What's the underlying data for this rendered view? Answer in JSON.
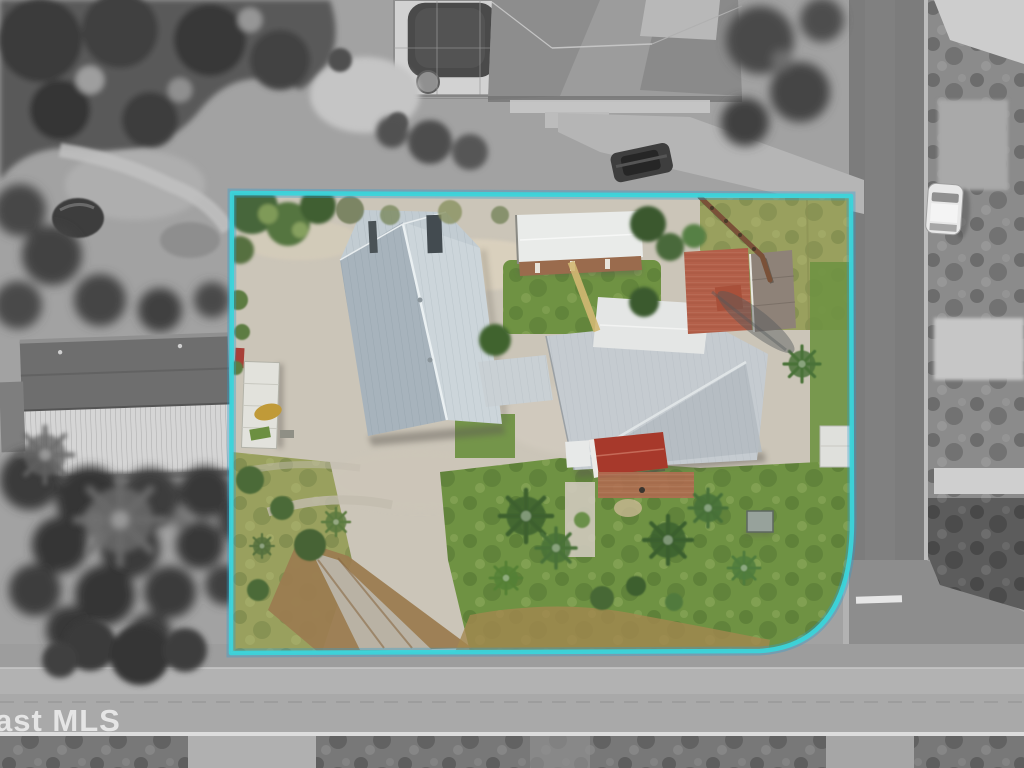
{
  "image": {
    "kind": "aerial-drone-photo",
    "width": 1024,
    "height": 768,
    "description": "Top-down aerial photo of a residential lot outlined in cyan; everything outside the outline is desaturated to grayscale"
  },
  "watermark": {
    "text": "ast MLS",
    "color": "rgba(255,255,255,0.82)"
  },
  "lot_outline": {
    "stroke_width": 4.5,
    "rounded_corner": "bottom-right",
    "corners": {
      "top_left": [
        232,
        193
      ],
      "top_right": [
        851,
        196
      ],
      "curve_start_right": [
        852,
        518
      ],
      "curve_end_bottom": [
        760,
        651
      ],
      "bottom_left": [
        231,
        653
      ]
    }
  },
  "palette": {
    "boundary": "#3bd4da",
    "boundary_glow": "#2a9fd0",
    "gravel": "#cbc5b8",
    "lawn": "#6f9243",
    "lawn_olive": "#99a05e",
    "roof_west": "#a7b3bc",
    "roof_east": "#ccd5da",
    "roof_white": "#e9ebe9",
    "roof_red": "#a7392b",
    "brick": "#b3604a",
    "dirt": "#9b7c50",
    "asphalt": "#7c7c7c",
    "road_light": "#a9a9a9",
    "scrub": "#8b8b8b",
    "palm": "#3f6330",
    "pool": "#4a4a4a",
    "car_white": "#e8e8e8",
    "car_dark": "#3e3e3e",
    "watermark": "rgba(255,255,255,0.82)"
  },
  "scene": {
    "inside_lot": {
      "ground": "gravel yard with sandy patches",
      "buildings": [
        "long metal-roof workshop with hipped north end",
        "white utility shed with brick south wall",
        "breezeway connector",
        "main house with white wing and red porch roof",
        "brick patio with small outbuilding",
        "small white shed on east edge"
      ],
      "features": [
        "white travel trailer",
        "parked yard equipment",
        "dirt driveway to south road",
        "yellow garden path",
        "wood fence",
        "gray utility box",
        "palm trees and lawns"
      ]
    },
    "outside_lot": {
      "top": "neighboring house with screened pool and dark car on driveway",
      "left": "barn with corrugated roof among dense trees",
      "right": "road with white car parked on shoulder and vacant scrub lots",
      "bottom": "cross street with white edge line and grass shoulder",
      "corner": "street intersection with painted stop bar"
    }
  }
}
